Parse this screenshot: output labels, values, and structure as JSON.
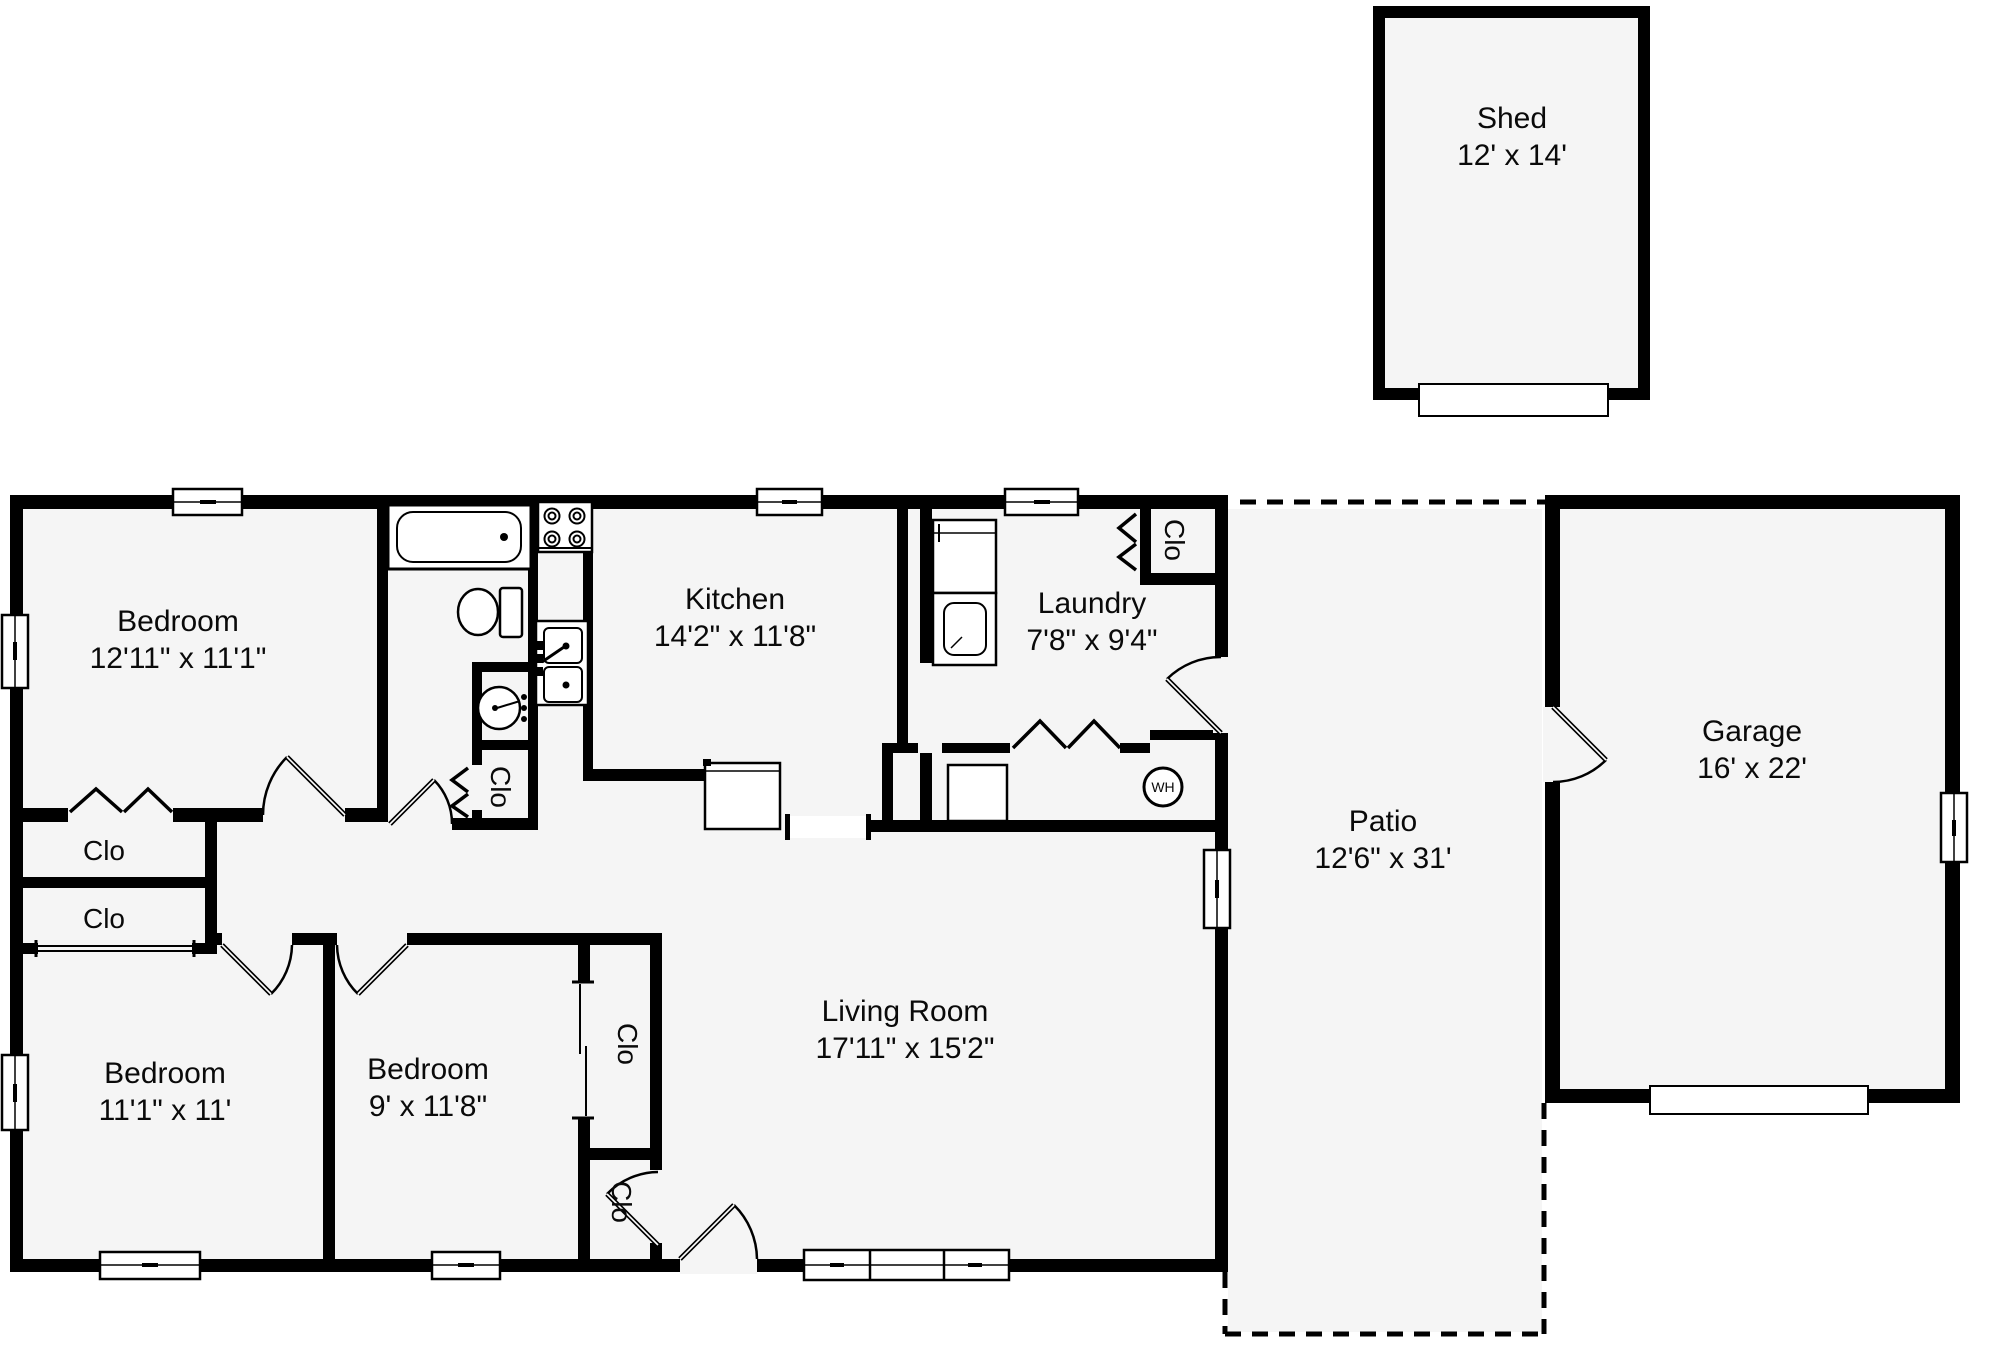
{
  "floor_plan": {
    "rooms": {
      "shed": {
        "name": "Shed",
        "dims": "12' x 14'"
      },
      "bedroom1": {
        "name": "Bedroom",
        "dims": "12'11\" x 11'1\""
      },
      "kitchen": {
        "name": "Kitchen",
        "dims": "14'2\" x 11'8\""
      },
      "laundry": {
        "name": "Laundry",
        "dims": "7'8\" x 9'4\""
      },
      "bedroom2": {
        "name": "Bedroom",
        "dims": "11'1\" x 11'"
      },
      "bedroom3": {
        "name": "Bedroom",
        "dims": "9' x 11'8\""
      },
      "living_room": {
        "name": "Living Room",
        "dims": "17'11\" x 15'2\""
      },
      "patio": {
        "name": "Patio",
        "dims": "12'6\" x 31'"
      },
      "garage": {
        "name": "Garage",
        "dims": "16' x 22'"
      }
    },
    "labels": {
      "closet": "Clo",
      "water_heater": "WH"
    },
    "colors": {
      "wall": "#000000",
      "room_fill": "#f5f5f5",
      "background": "#ffffff"
    }
  }
}
